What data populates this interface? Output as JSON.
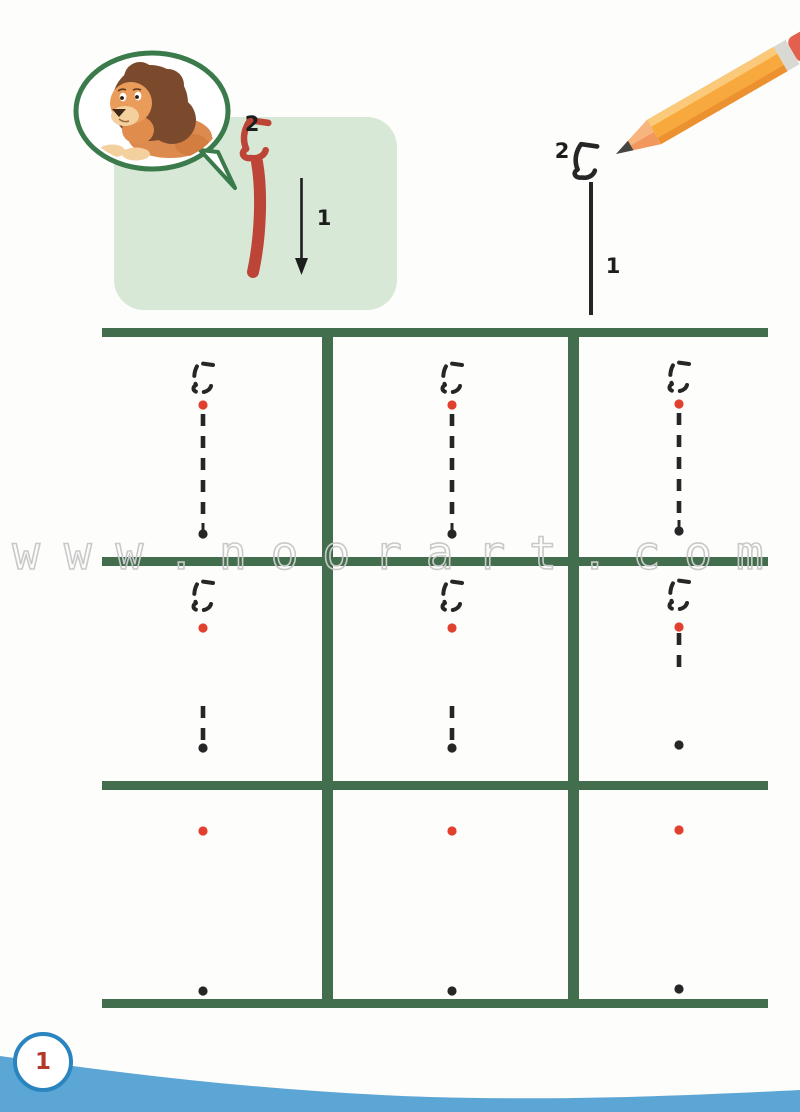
{
  "page": {
    "number": "1",
    "watermark": "www.noorart.com"
  },
  "colors": {
    "grid-green": "#436e4e",
    "box-green": "#d7e9d6",
    "bubble-green": "#3a7a4b",
    "letter-red": "#bd4538",
    "dot-red": "#e2402e",
    "ink-black": "#262626",
    "wave-blue": "#5ca6d5",
    "badge-blue": "#2a84bf",
    "badge-red": "#b5382b",
    "watermark-gray": "#c9c9c9"
  },
  "illustrations": {
    "bubble": "lion",
    "top_right": "pencil"
  },
  "example_box": {
    "letter": "أ",
    "hamza": "ء",
    "stroke1_label": "1",
    "stroke2_label": "2"
  },
  "practice_example": {
    "letter": "أ",
    "hamza": "ء",
    "stroke1_label": "1",
    "stroke2_label": "2"
  },
  "trace_grid": {
    "rows": 3,
    "cols": 3,
    "cells": [
      {
        "row": 1,
        "col": 1,
        "cx": 203,
        "hamza_top": 362,
        "red_dot_y": 405,
        "dashes": [
          [
            414,
            520
          ]
        ],
        "end_dot_y": 534,
        "end_style": "teardrop"
      },
      {
        "row": 1,
        "col": 2,
        "cx": 452,
        "hamza_top": 362,
        "red_dot_y": 405,
        "dashes": [
          [
            414,
            520
          ]
        ],
        "end_dot_y": 534,
        "end_style": "teardrop"
      },
      {
        "row": 1,
        "col": 3,
        "cx": 679,
        "hamza_top": 361,
        "red_dot_y": 404,
        "dashes": [
          [
            413,
            517
          ]
        ],
        "end_dot_y": 531,
        "end_style": "teardrop"
      },
      {
        "row": 2,
        "col": 1,
        "cx": 203,
        "hamza_top": 580,
        "red_dot_y": 628,
        "dashes": [
          [
            706,
            740
          ]
        ],
        "end_dot_y": 748,
        "end_style": "round"
      },
      {
        "row": 2,
        "col": 2,
        "cx": 452,
        "hamza_top": 580,
        "red_dot_y": 628,
        "dashes": [
          [
            706,
            740
          ]
        ],
        "end_dot_y": 748,
        "end_style": "round"
      },
      {
        "row": 2,
        "col": 3,
        "cx": 679,
        "hamza_top": 579,
        "red_dot_y": 627,
        "dashes": [
          [
            633,
            674
          ]
        ],
        "end_dot_y": 745,
        "end_style": "round"
      },
      {
        "row": 3,
        "col": 1,
        "cx": 203,
        "red_dot_y": 831,
        "end_dot_y": 991,
        "end_style": "round"
      },
      {
        "row": 3,
        "col": 2,
        "cx": 452,
        "red_dot_y": 831,
        "end_dot_y": 991,
        "end_style": "round"
      },
      {
        "row": 3,
        "col": 3,
        "cx": 679,
        "red_dot_y": 830,
        "end_dot_y": 989,
        "end_style": "round"
      }
    ]
  }
}
